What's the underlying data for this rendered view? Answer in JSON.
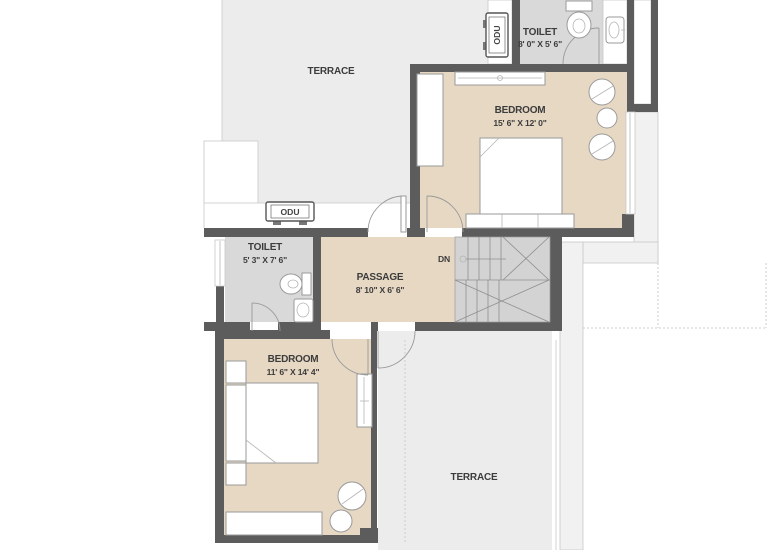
{
  "colors": {
    "wall": "#5c5c5c",
    "terrace-fill": "#ececec",
    "room-fill": "#e7d8c4",
    "toilet-fill": "#d9d9d9",
    "stairs-fill": "#d3d3d3",
    "balcony-fill": "#f1f1f1",
    "fixture-stroke": "#9a9a9a",
    "outline": "#c8c8c8",
    "label-color": "#3c3c3c"
  },
  "rooms": {
    "terrace_top": {
      "label": "TERRACE"
    },
    "toilet_top": {
      "label": "TOILET",
      "dimensions": "8' 0\" X 5' 6\""
    },
    "bedroom_top": {
      "label": "BEDROOM",
      "dimensions": "15' 6\" X 12' 0\""
    },
    "toilet_middle": {
      "label": "TOILET",
      "dimensions": "5' 3\" X 7' 6\""
    },
    "passage": {
      "label": "PASSAGE",
      "dimensions": "8' 10\" X 6' 6\""
    },
    "bedroom_bottom": {
      "label": "BEDROOM",
      "dimensions": "11' 6\" X 14' 4\""
    },
    "terrace_bottom": {
      "label": "TERRACE"
    }
  },
  "annotations": {
    "odu_top": "ODU",
    "odu_middle": "ODU",
    "stairs_down": "DN"
  }
}
